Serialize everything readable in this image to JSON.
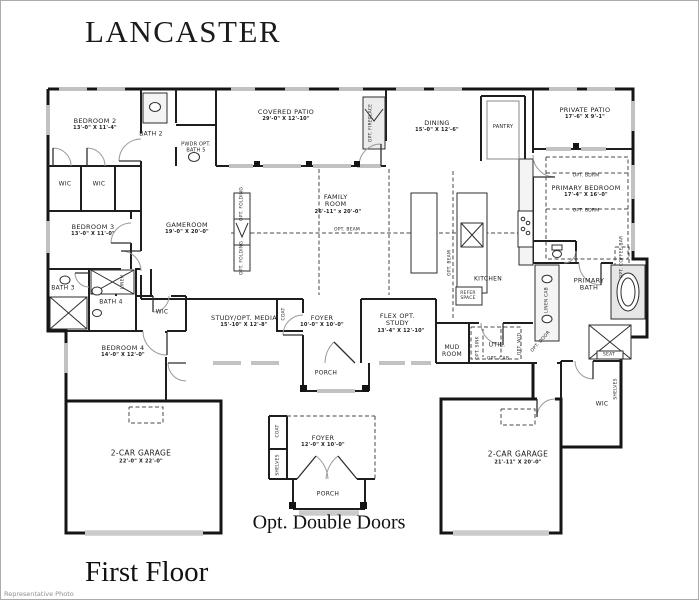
{
  "page": {
    "title": "LANCASTER",
    "floor_label": "First Floor",
    "caption": "Opt. Double Doors",
    "watermark": "Representative Photo"
  },
  "rooms": {
    "bedroom2": {
      "name": "BEDROOM 2",
      "dims": "13'-0\" X 11'-4\""
    },
    "bath2": {
      "name": "BATH 2"
    },
    "pwdr_opt_bath5": {
      "name": "PWDR OPT. BATH 5"
    },
    "wic1": {
      "name": "WIC"
    },
    "wic2": {
      "name": "WIC"
    },
    "bedroom3": {
      "name": "BEDROOM 3",
      "dims": "13'-0\" X 11'-0\""
    },
    "bath3": {
      "name": "BATH 3"
    },
    "bath4": {
      "name": "BATH 4"
    },
    "linen": {
      "name": "LINEN"
    },
    "wic3": {
      "name": "WIC"
    },
    "bedroom4": {
      "name": "BEDROOM 4",
      "dims": "14'-0\" X 12'-0\""
    },
    "garage_left": {
      "name": "2-CAR GARAGE",
      "dims": "22'-0\" X 22'-0\""
    },
    "covered_patio": {
      "name": "COVERED PATIO",
      "dims": "29'-0\" X 12'-10\""
    },
    "opt_fireplace": {
      "name": "OPT. FIREPLACE"
    },
    "gameroom": {
      "name": "GAMEROOM",
      "dims": "19'-0\" X 20'-0\""
    },
    "family_room": {
      "name": "FAMILY ROOM",
      "dims": "26'-11\" x 20'-0\""
    },
    "opt_beam_1": {
      "name": "OPT. BEAM"
    },
    "opt_beam_2": {
      "name": "OPT. BEAM"
    },
    "opt_folding_1": {
      "name": "OPT. FOLDING"
    },
    "opt_folding_2": {
      "name": "OPT. FOLDING"
    },
    "dining": {
      "name": "DINING",
      "dims": "15'-0\" X 12'-6\""
    },
    "pantry": {
      "name": "PANTRY"
    },
    "private_patio": {
      "name": "PRIVATE PATIO",
      "dims": "17'-6\" X 9'-1\""
    },
    "primary_bedroom": {
      "name": "PRIMARY BEDROOM",
      "dims": "17'-4\" X 16'-0\""
    },
    "opt_bdrm_top": {
      "name": "OPT. BDRM"
    },
    "opt_bdrm_bottom": {
      "name": "OPT. BDRM"
    },
    "kitchen": {
      "name": "KITCHEN"
    },
    "refer_space": {
      "name": "REFER SPACE"
    },
    "mud_room": {
      "name": "MUD ROOM"
    },
    "util": {
      "name": "UTIL."
    },
    "opt_sink": {
      "name": "OPT. SINK"
    },
    "opt_wd": {
      "name": "OPT. W/D"
    },
    "opt_cab": {
      "name": "OPT. CAB"
    },
    "opt_door": {
      "name": "OPT. DOOR"
    },
    "study": {
      "name": "STUDY/OPT. MEDIA",
      "dims": "15'-10\" X 12'-8\""
    },
    "foyer": {
      "name": "FOYER",
      "dims": "10'-0\" X 10'-0\""
    },
    "coat": {
      "name": "COAT"
    },
    "porch": {
      "name": "PORCH"
    },
    "flex": {
      "name": "FLEX OPT. STUDY",
      "dims": "13'-4\" X 12'-10\""
    },
    "primary_bath": {
      "name": "PRIMARY BATH"
    },
    "linen_cab": {
      "name": "LINEN CAB"
    },
    "opt_coffee_bar": {
      "name": "OPT. COFFEE BAR"
    },
    "seat": {
      "name": "SEAT"
    },
    "shelves": {
      "name": "SHELVES"
    },
    "wic_primary": {
      "name": "WIC"
    },
    "garage_right": {
      "name": "2-CAR GARAGE",
      "dims": "21'-11\" X 20'-0\""
    },
    "inset_foyer": {
      "name": "FOYER",
      "dims": "12'-0\" X 10'-0\""
    },
    "inset_coat": {
      "name": "COAT"
    },
    "inset_shelves": {
      "name": "SHELVES"
    },
    "inset_porch": {
      "name": "PORCH"
    }
  }
}
